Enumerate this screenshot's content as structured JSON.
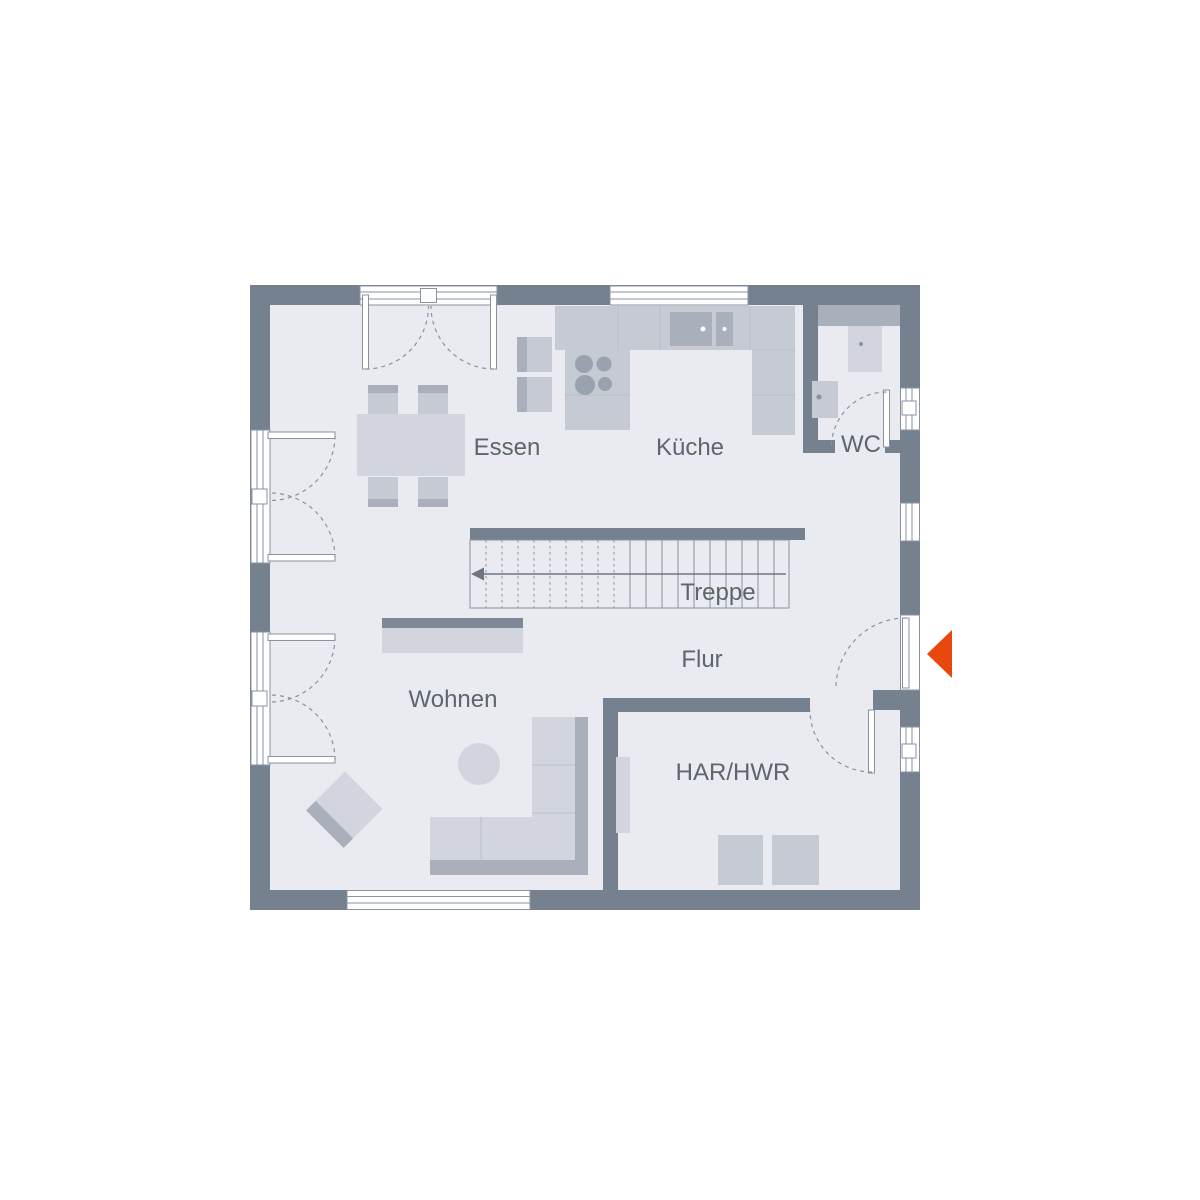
{
  "rooms": {
    "essen": {
      "label": "Essen"
    },
    "kueche": {
      "label": "Küche"
    },
    "wc": {
      "label": "WC"
    },
    "treppe": {
      "label": "Treppe"
    },
    "flur": {
      "label": "Flur"
    },
    "wohnen": {
      "label": "Wohnen"
    },
    "har_hwr": {
      "label": "HAR/HWR"
    }
  },
  "icons": {
    "entrance": "entrance-arrow-icon",
    "stairs_direction": "arrow-left-icon"
  },
  "colors": {
    "wall": "#76818F",
    "floor": "#E9EBF0",
    "outline": "#8A92A0",
    "furniture_light": "#D2D5DD",
    "furniture_mid": "#C5CAD3",
    "furniture_dark": "#A9AFBB",
    "furniture_band": "#7E8896",
    "divider": "#B9BFCA",
    "burner": "#9AA2B0",
    "dot": "#8B93A0",
    "label_text": "#5D6570",
    "stair_arrow": "#6E7682",
    "accent": "#E8470E",
    "background": "#FFFFFF"
  }
}
